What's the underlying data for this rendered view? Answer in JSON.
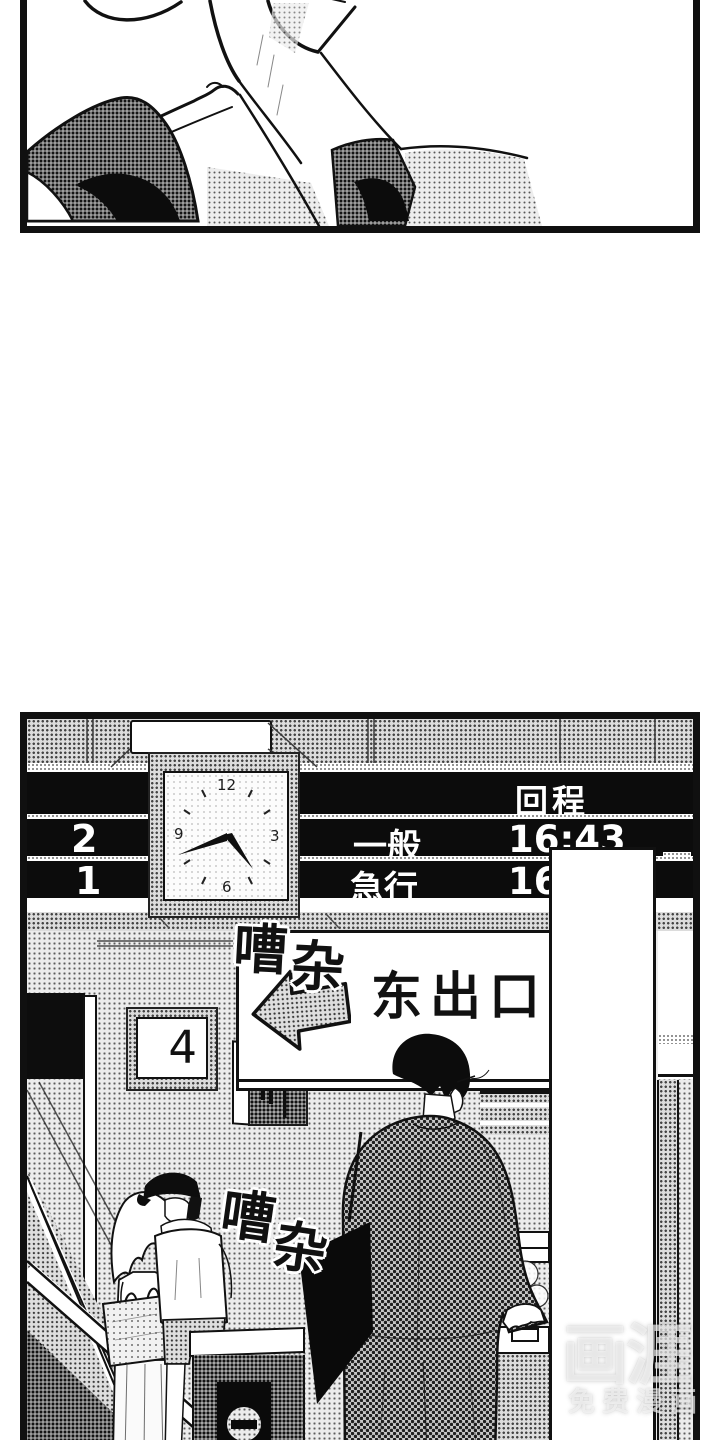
{
  "station_board": {
    "header": "回程",
    "platforms_left": [
      "2",
      "1"
    ],
    "departures": [
      {
        "service": "一般",
        "time": "16:43"
      },
      {
        "service": "急行",
        "time": "16"
      }
    ]
  },
  "clock": {
    "numeral_top": "12",
    "numeral_right": "3",
    "numeral_bottom": "6",
    "numeral_left": "9",
    "hands": {
      "hour_angle_deg": 142,
      "minute_angle_deg": 250
    }
  },
  "signs": {
    "exit": {
      "label": "东出口",
      "arrow": "left"
    },
    "platform": {
      "number": "4"
    }
  },
  "sfx": {
    "noise1": {
      "char1": "嘈",
      "char2": "杂"
    },
    "noise2": {
      "char1": "嘈",
      "char2": "杂"
    }
  },
  "watermark": {
    "logo": "画涯",
    "tagline": "免费漫画"
  },
  "colors": {
    "ink": "#111111",
    "paper": "#ffffff",
    "board": "#0c0c0c"
  }
}
